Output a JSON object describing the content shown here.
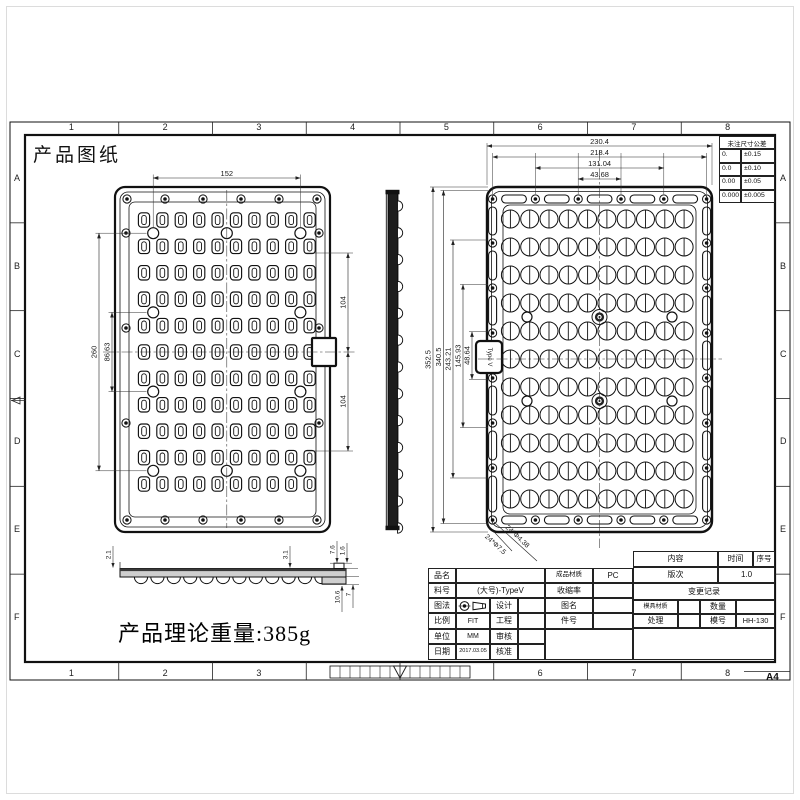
{
  "sheet": {
    "title": "产品图纸",
    "weight_note": "产品理论重量:385g",
    "paper_size": "A4",
    "zones_h": [
      "1",
      "2",
      "3",
      "4",
      "5",
      "6",
      "7",
      "8"
    ],
    "zones_v": [
      "A",
      "B",
      "C",
      "D",
      "E",
      "F"
    ]
  },
  "tolerance_table": {
    "header": "未注尺寸公差",
    "rows": [
      {
        "digits": "0.",
        "tol": "±0.15"
      },
      {
        "digits": "0.0",
        "tol": "±0.10"
      },
      {
        "digits": "0.00",
        "tol": "±0.05"
      },
      {
        "digits": "0.000",
        "tol": "±0.005"
      }
    ]
  },
  "title_block": {
    "part_name_label": "品名",
    "part_no_label": "料号",
    "part_no": "(大号)-TypeV",
    "projection_label": "图法",
    "design_label": "设计",
    "scale_label": "比例",
    "scale": "FIT",
    "engineer_label": "工程",
    "unit_label": "单位",
    "unit": "MM",
    "review_label": "审核",
    "date_label": "日期",
    "date": "2017.03.05",
    "approve_label": "核准",
    "material_label": "成品材质",
    "material": "PC",
    "shrinkage_label": "收缩率",
    "drawing_name_label": "图名",
    "part_id_label": "件号",
    "content_label": "内容",
    "time_label": "时间",
    "seq_label": "序号",
    "revision_label": "版次",
    "revision": "1.0",
    "change_record_label": "变更记录",
    "mold_material_label": "模具材质",
    "qty_label": "数量",
    "treatment_label": "处理",
    "mold_no_label": "模号",
    "mold_no": "HH-130"
  },
  "views": {
    "left_view": {
      "dims": {
        "width_top": "152",
        "height_outer": "260",
        "height_inner": "86.63",
        "right_upper": "104",
        "right_lower": "104"
      }
    },
    "right_view": {
      "dims_top": [
        "230.4",
        "218.4",
        "131.04",
        "43.68"
      ],
      "dims_left": [
        "352.5",
        "340.5",
        "243.21",
        "145.93",
        "48.64"
      ],
      "hole_notes": [
        "24*Φ4.38",
        "24*Φ7.5"
      ],
      "tab_text": "Type V"
    },
    "profile": {
      "dims": {
        "left": "2.1",
        "mid": "3.1",
        "lip_a": "7.6",
        "lip_b": "1.6",
        "bottom_a": "10.6",
        "bottom_b": "7"
      }
    }
  }
}
